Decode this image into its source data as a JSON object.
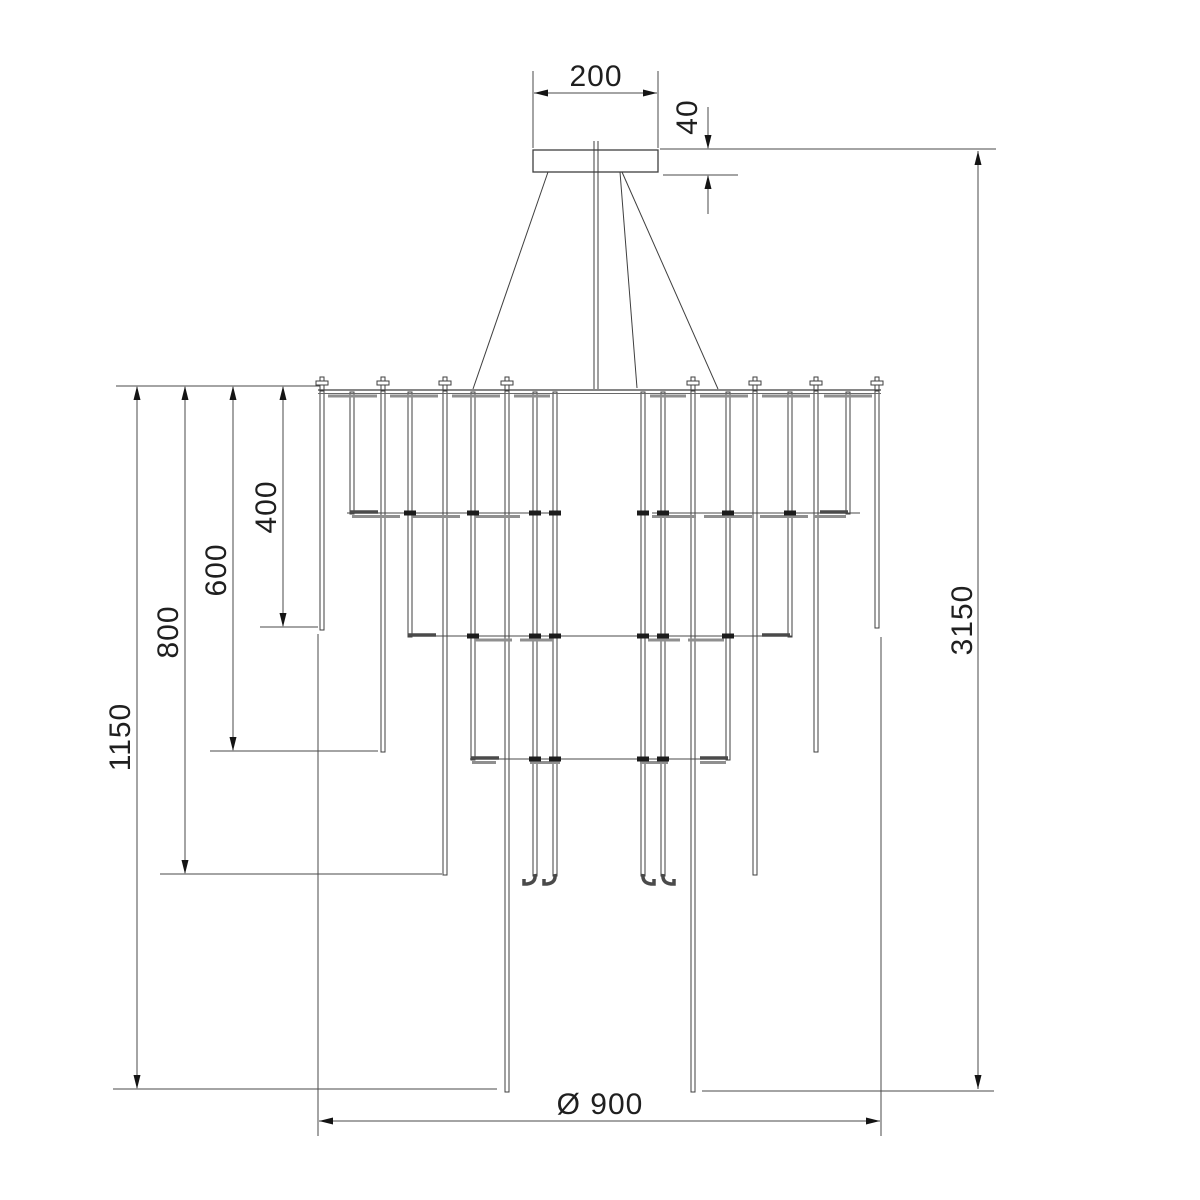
{
  "drawing": {
    "colors": {
      "line": "#3f3f3f",
      "dimension_line": "#4a4a4a",
      "text": "#1f1f1f",
      "background": "#ffffff"
    },
    "dimensions": {
      "canopy_width": "200",
      "canopy_height": "40",
      "overall_height": "3150",
      "rod_drop_short": "400",
      "rod_drop_medium": "600",
      "rod_drop_long": "800",
      "rod_drop_longest": "1150",
      "body_diameter": "Ø 900"
    }
  }
}
